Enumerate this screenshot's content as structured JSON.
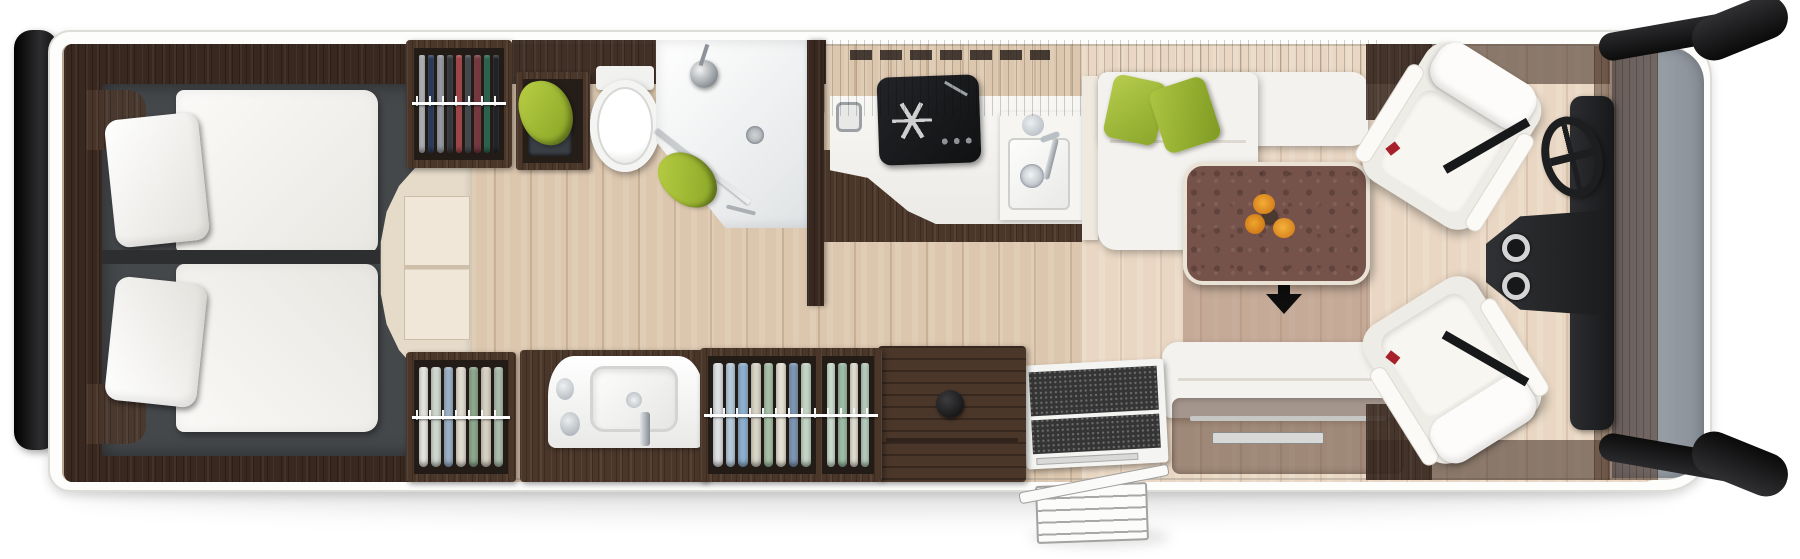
{
  "scene": {
    "kind": "motorhome-floorplan-top-view",
    "orientation": {
      "vehicle_front": "right",
      "vehicle_rear": "left"
    }
  },
  "rooms": [
    {
      "name": "rear-bedroom",
      "furniture": [
        "twin-bed-upper",
        "twin-bed-lower",
        "pillows",
        "center-steps",
        "headboard-cabinets"
      ]
    },
    {
      "name": "bathroom",
      "furniture": [
        "hanging-wardrobe",
        "toilet",
        "corner-shower",
        "washbasin-vanity",
        "green-towels"
      ]
    },
    {
      "name": "kitchen",
      "furniture": [
        "gas-hob",
        "kitchen-sink",
        "curved-worktop",
        "overhead-cabinets",
        "drawer-cabinet"
      ]
    },
    {
      "name": "lounge",
      "furniture": [
        "l-shaped-sofa",
        "green-cushions",
        "dining-table",
        "flower-vase",
        "travel-bench-seat",
        "drop-down-bed-indicator"
      ]
    },
    {
      "name": "entrance",
      "furniture": [
        "entry-door",
        "doormat",
        "exterior-folding-step"
      ]
    },
    {
      "name": "cab",
      "furniture": [
        "driver-swivel-seat",
        "passenger-swivel-seat",
        "steering-wheel",
        "dashboard",
        "cup-holders",
        "windshield",
        "side-mirror-top",
        "side-mirror-bottom",
        "rear-bumper"
      ]
    }
  ],
  "wardrobe_clothes": {
    "top_dark": [
      "#b9bcc0",
      "#2e3f63",
      "#9aa1a8",
      "#3a3d42",
      "#b14a50",
      "#4a4e54",
      "#7e3b43",
      "#2f6b55",
      "#23262b"
    ],
    "bottom_left_light": [
      "#e8e6e0",
      "#cfd8cf",
      "#9db3c9",
      "#e2ddd2",
      "#8fa98f",
      "#d8d2c4",
      "#aebfae"
    ],
    "bottom_mid_light": [
      "#dfe3e6",
      "#b9cede",
      "#8fb0cf",
      "#d9d6c8",
      "#a9c3a9",
      "#e6e2d6",
      "#7f98b5",
      "#c5d6c5"
    ],
    "bottom_mid_small": [
      "#cfe0d4",
      "#9fbfa8",
      "#e4e0d4",
      "#b8cfc0"
    ]
  },
  "palette": {
    "body_shell": "#ffffff",
    "wood_dark": "#38281f",
    "wood_mid": "#4b372a",
    "floor_parquet": "#dcc7ae",
    "floor_lounge": "#e9d7c3",
    "bed_platform": "#45484b",
    "bedding_white": "#f4f2ee",
    "accent_green": "#a6c13c",
    "table_top": "#75524a",
    "fixture_dark": "#1a1b1d",
    "windshield_glass": "#8e959d",
    "flower_orange": "#e8921e"
  },
  "symbols": {
    "entry_arrow_direction": "down"
  }
}
